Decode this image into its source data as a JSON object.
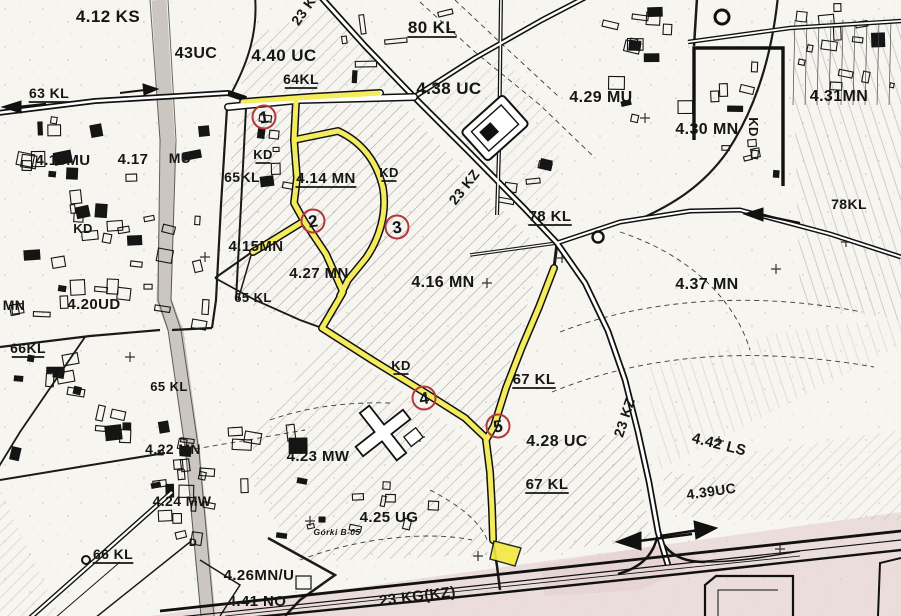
{
  "map": {
    "description": "scanned zoning plan with highlighted route",
    "colors": {
      "paper": "#f7f5f0",
      "ink": "#161616",
      "highlight_yellow": "#f2e93d",
      "marker_red": "#b5383b",
      "corridor_pink": "#e2c9cb",
      "road_gray": "#cbc6bf"
    },
    "labels": [
      {
        "text": "4.12 KS",
        "x": 108,
        "y": 22,
        "size": 17
      },
      {
        "text": "43UC",
        "x": 196,
        "y": 58,
        "size": 16
      },
      {
        "text": "4.40 UC",
        "x": 284,
        "y": 61,
        "size": 17
      },
      {
        "text": "80 KL",
        "x": 432,
        "y": 33,
        "size": 17,
        "u": 1
      },
      {
        "text": "4.38 UC",
        "x": 449,
        "y": 94,
        "size": 17
      },
      {
        "text": "4.29 MU",
        "x": 601,
        "y": 102,
        "size": 16
      },
      {
        "text": "4.31MN",
        "x": 839,
        "y": 101,
        "size": 16
      },
      {
        "text": "4.30 MN",
        "x": 707,
        "y": 134,
        "size": 16
      },
      {
        "text": "KD",
        "x": 749,
        "y": 127,
        "size": 13,
        "rot": 90
      },
      {
        "text": "63 KL",
        "x": 49,
        "y": 98,
        "size": 14,
        "u": 1
      },
      {
        "text": "64KL",
        "x": 301,
        "y": 84,
        "size": 14,
        "u": 1
      },
      {
        "text": "4.18MU",
        "x": 63,
        "y": 165,
        "size": 15
      },
      {
        "text": "4.17",
        "x": 133,
        "y": 164,
        "size": 15
      },
      {
        "text": "MU",
        "x": 180,
        "y": 163,
        "size": 14
      },
      {
        "text": "KD",
        "x": 263,
        "y": 159,
        "size": 13,
        "u": 1
      },
      {
        "text": "65KL",
        "x": 242,
        "y": 182,
        "size": 14
      },
      {
        "text": "4.14 MN",
        "x": 326,
        "y": 183,
        "size": 15,
        "u": 1
      },
      {
        "text": "KD",
        "x": 389,
        "y": 177,
        "size": 13,
        "u": 1
      },
      {
        "text": "4.15MN",
        "x": 256,
        "y": 251,
        "size": 15
      },
      {
        "text": "KD",
        "x": 83,
        "y": 233,
        "size": 13
      },
      {
        "text": "4.27 MN",
        "x": 319,
        "y": 278,
        "size": 15
      },
      {
        "text": "4.16 MN",
        "x": 443,
        "y": 287,
        "size": 16
      },
      {
        "text": "65 KL",
        "x": 253,
        "y": 302,
        "size": 13
      },
      {
        "text": "MN",
        "x": 14,
        "y": 310,
        "size": 14
      },
      {
        "text": "4.20UD",
        "x": 94,
        "y": 309,
        "size": 15
      },
      {
        "text": "66KL",
        "x": 28,
        "y": 353,
        "size": 14,
        "u": 1
      },
      {
        "text": "78 KL",
        "x": 550,
        "y": 221,
        "size": 15,
        "u": 1
      },
      {
        "text": "78KL",
        "x": 849,
        "y": 209,
        "size": 14
      },
      {
        "text": "4.37 MN",
        "x": 707,
        "y": 289,
        "size": 16
      },
      {
        "text": "23 KZ",
        "x": 468,
        "y": 190,
        "size": 14,
        "rot": -52
      },
      {
        "text": "23 KZ",
        "x": 629,
        "y": 419,
        "size": 14,
        "rot": -72
      },
      {
        "text": "23 KZ",
        "x": 310,
        "y": 10,
        "size": 14,
        "rot": -55
      },
      {
        "text": "KD",
        "x": 401,
        "y": 370,
        "size": 13,
        "u": 1
      },
      {
        "text": "67 KL",
        "x": 534,
        "y": 384,
        "size": 15,
        "u": 1
      },
      {
        "text": "4.28 UC",
        "x": 557,
        "y": 446,
        "size": 16
      },
      {
        "text": "67 KL",
        "x": 547,
        "y": 489,
        "size": 15,
        "u": 1
      },
      {
        "text": "4.23 MW",
        "x": 318,
        "y": 461,
        "size": 15
      },
      {
        "text": "65 KL",
        "x": 169,
        "y": 391,
        "size": 13
      },
      {
        "text": "4.22 MN",
        "x": 173,
        "y": 454,
        "size": 14
      },
      {
        "text": "4.24 MW",
        "x": 182,
        "y": 506,
        "size": 14
      },
      {
        "text": "4.25 UG",
        "x": 389,
        "y": 522,
        "size": 15
      },
      {
        "text": "Górki B-05",
        "x": 337,
        "y": 535,
        "size": 8.5,
        "italic": 1
      },
      {
        "text": "66 KL",
        "x": 113,
        "y": 559,
        "size": 14,
        "u": 1
      },
      {
        "text": "D",
        "x": 193,
        "y": 546,
        "size": 11
      },
      {
        "text": "4.26MN/U",
        "x": 259,
        "y": 580,
        "size": 15
      },
      {
        "text": "4.41 NO",
        "x": 257,
        "y": 606,
        "size": 15
      },
      {
        "text": "23 KG(KZ)",
        "x": 418,
        "y": 601,
        "size": 15,
        "rot": -7
      },
      {
        "text": "4.39UC",
        "x": 712,
        "y": 496,
        "size": 14,
        "rot": -8
      },
      {
        "text": "4.42 LS",
        "x": 718,
        "y": 449,
        "size": 15,
        "rot": 14
      }
    ],
    "markers": [
      {
        "n": "1",
        "x": 264,
        "y": 117
      },
      {
        "n": "2",
        "x": 313,
        "y": 221
      },
      {
        "n": "3",
        "x": 397,
        "y": 227
      },
      {
        "n": "4",
        "x": 424,
        "y": 398
      },
      {
        "n": "5",
        "x": 498,
        "y": 426
      }
    ]
  }
}
